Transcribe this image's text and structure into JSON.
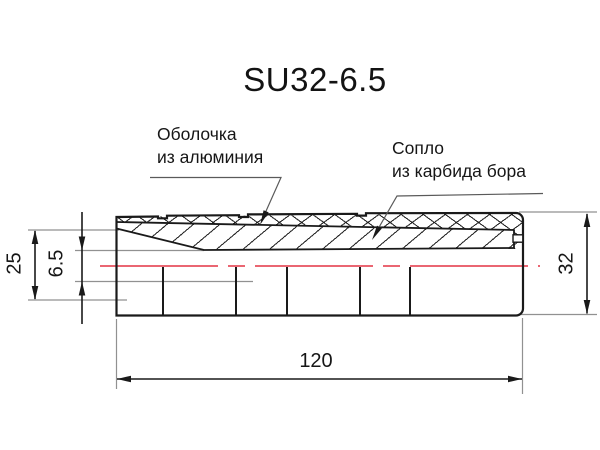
{
  "title": "SU32-6.5",
  "labels": {
    "shell": {
      "line1": "Оболочка",
      "line2": "из алюминия"
    },
    "nozzle": {
      "line1": "Сопло",
      "line2": "из карбида бора"
    }
  },
  "dimensions": {
    "inlet_diameter": "25",
    "bore_diameter": "6.5",
    "outer_diameter": "32",
    "length": "120"
  },
  "colors": {
    "object_line": "#1a1a1a",
    "extension_line": "#919191",
    "centerline_red": "#e8505f",
    "background": "#ffffff"
  }
}
